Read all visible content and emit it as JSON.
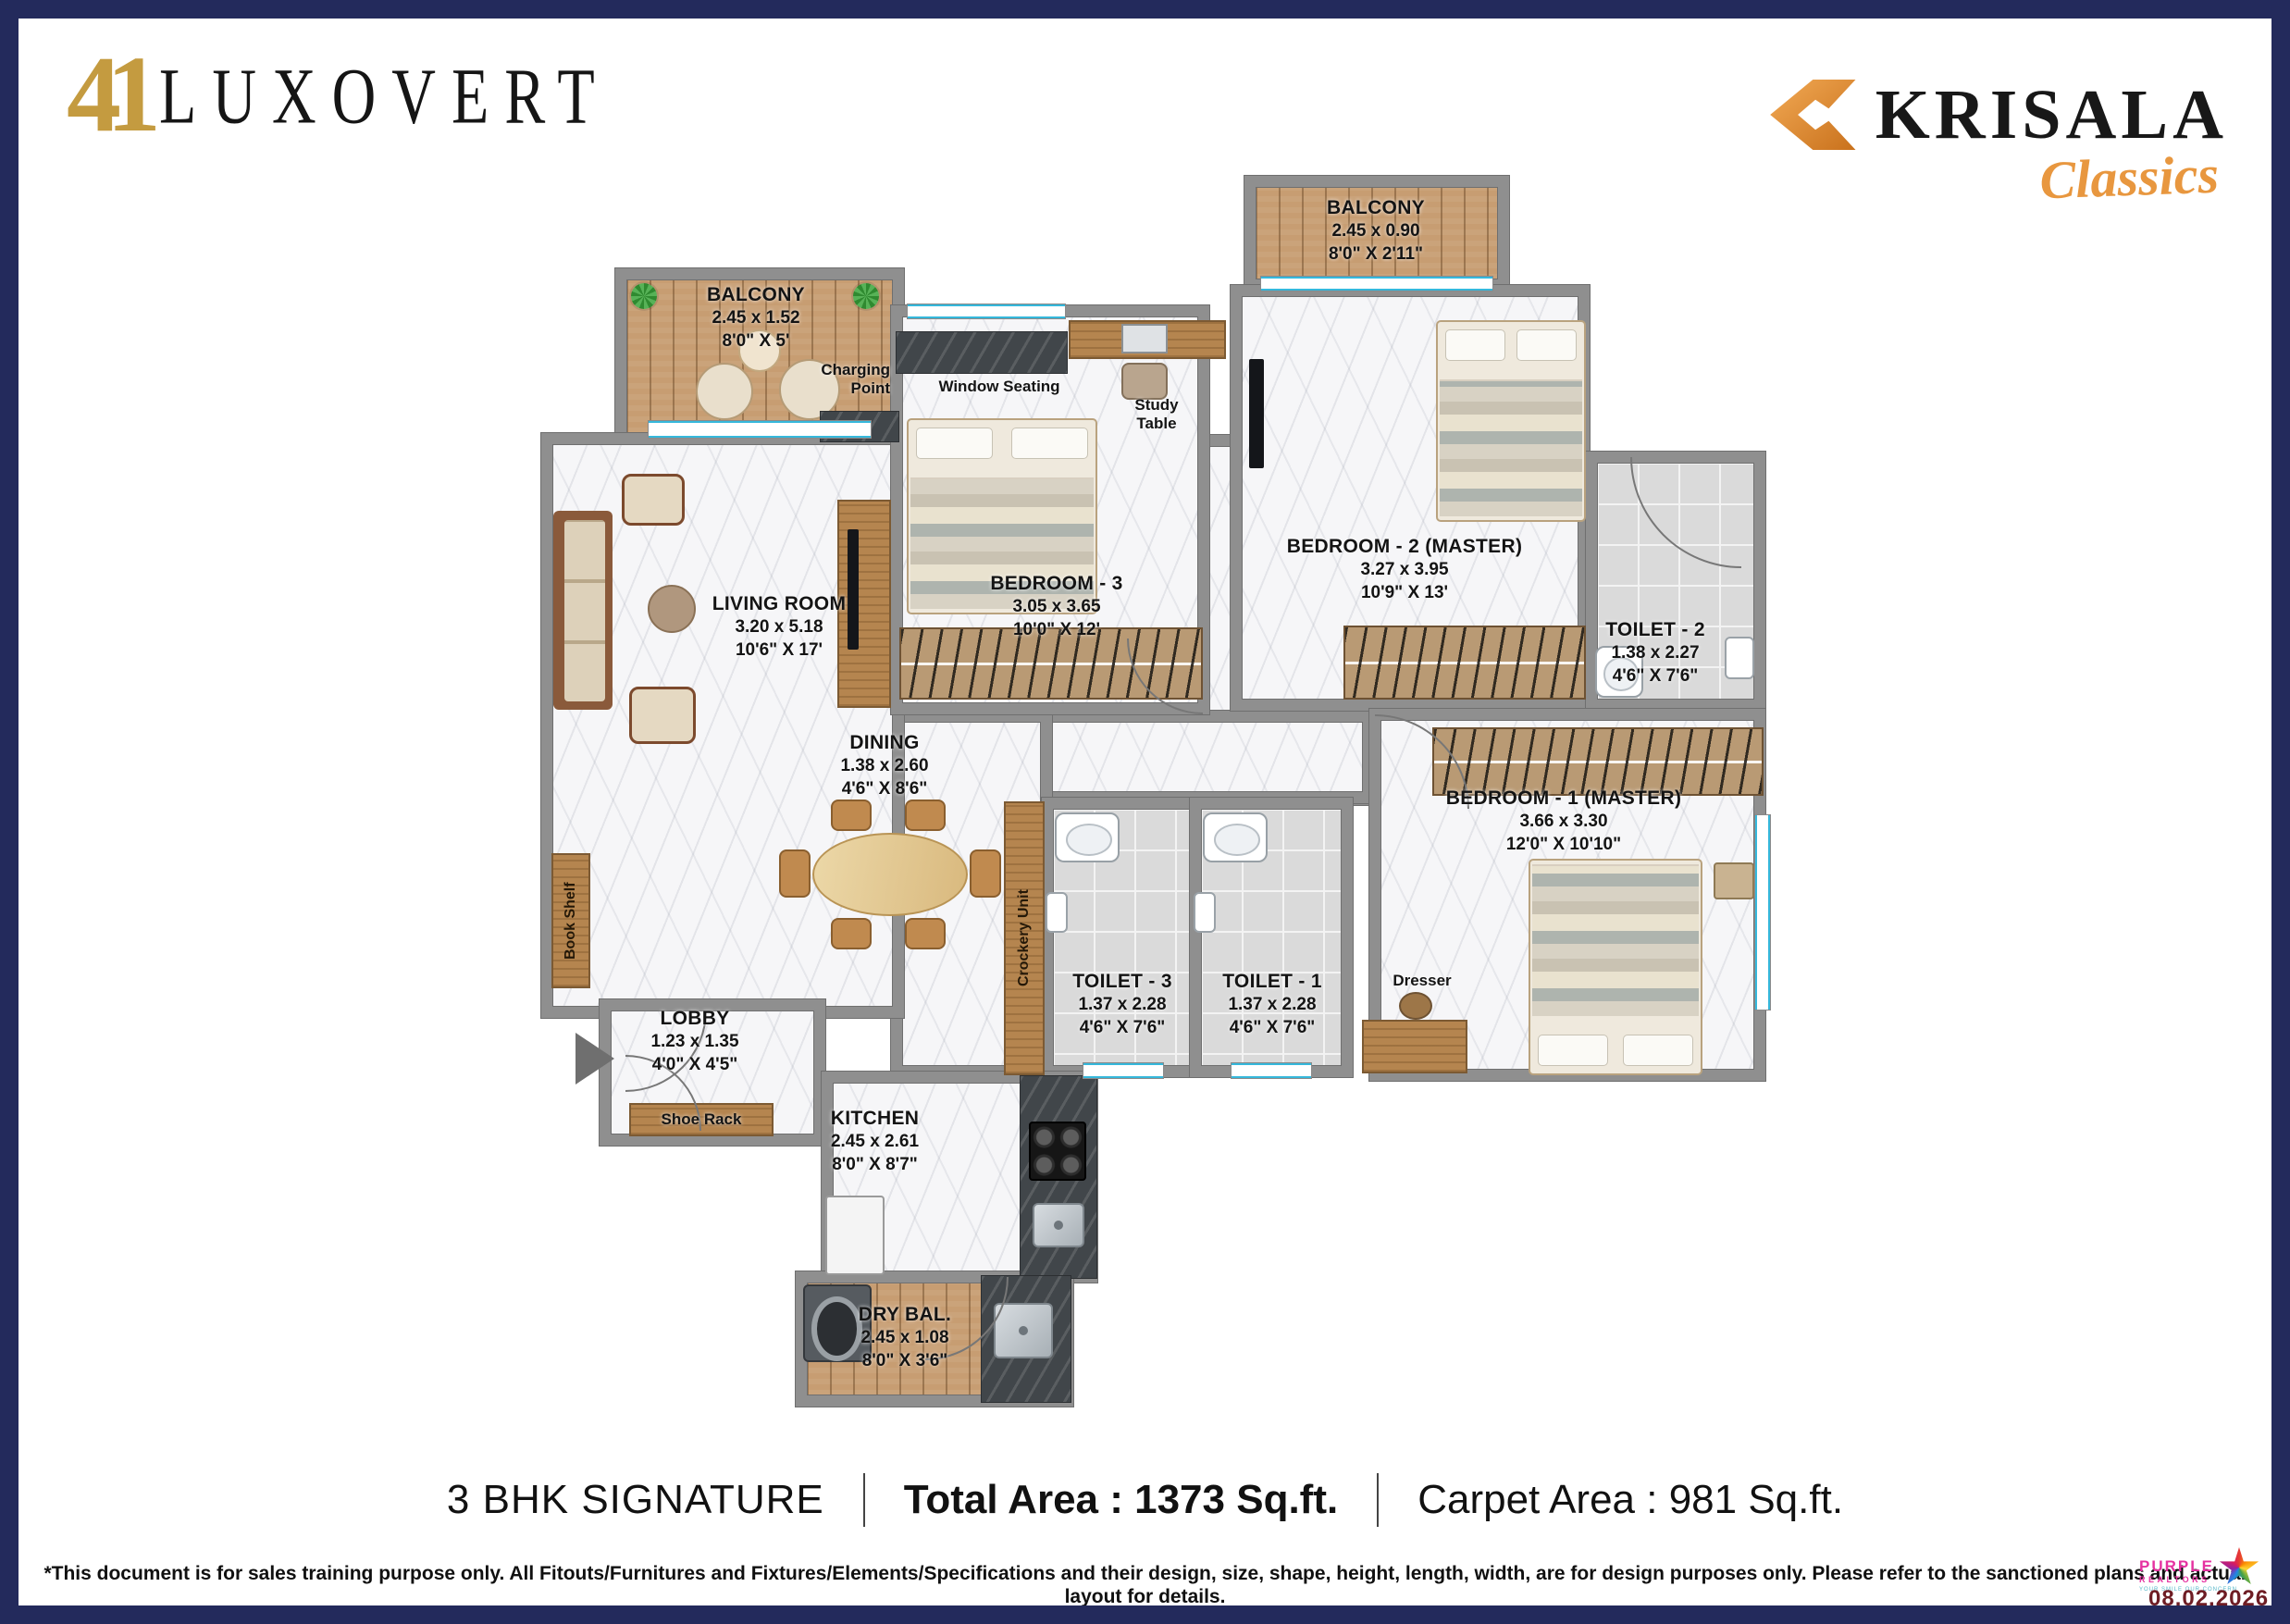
{
  "header": {
    "logo_number": "41",
    "logo_name": "LUXOVERT",
    "brand_name": "KRISALA",
    "brand_sub": "Classics"
  },
  "rooms": {
    "balcony_left": {
      "name": "BALCONY",
      "dim_m": "2.45 x 1.52",
      "dim_ft": "8'0\" X 5'"
    },
    "balcony_top": {
      "name": "BALCONY",
      "dim_m": "2.45 x 0.90",
      "dim_ft": "8'0\" X 2'11\""
    },
    "living": {
      "name": "LIVING ROOM",
      "dim_m": "3.20 x 5.18",
      "dim_ft": "10'6\" X 17'"
    },
    "dining": {
      "name": "DINING",
      "dim_m": "1.38 x 2.60",
      "dim_ft": "4'6\" X 8'6\""
    },
    "bedroom3": {
      "name": "BEDROOM - 3",
      "dim_m": "3.05 x 3.65",
      "dim_ft": "10'0\" X 12'"
    },
    "bedroom2": {
      "name": "BEDROOM - 2 (MASTER)",
      "dim_m": "3.27 x 3.95",
      "dim_ft": "10'9\" X 13'"
    },
    "bedroom1": {
      "name": "BEDROOM - 1 (MASTER)",
      "dim_m": "3.66 x 3.30",
      "dim_ft": "12'0\" X 10'10\""
    },
    "toilet2": {
      "name": "TOILET - 2",
      "dim_m": "1.38 x 2.27",
      "dim_ft": "4'6\" X 7'6\""
    },
    "toilet3": {
      "name": "TOILET - 3",
      "dim_m": "1.37 x 2.28",
      "dim_ft": "4'6\" X 7'6\""
    },
    "toilet1": {
      "name": "TOILET - 1",
      "dim_m": "1.37 x 2.28",
      "dim_ft": "4'6\" X 7'6\""
    },
    "lobby": {
      "name": "LOBBY",
      "dim_m": "1.23 x 1.35",
      "dim_ft": "4'0\" X 4'5\""
    },
    "kitchen": {
      "name": "KITCHEN",
      "dim_m": "2.45 x 2.61",
      "dim_ft": "8'0\" X 8'7\""
    },
    "dry_balcony": {
      "name": "DRY BAL.",
      "dim_m": "2.45 x 1.08",
      "dim_ft": "8'0\" X 3'6\""
    }
  },
  "annotations": {
    "charging_point": "Charging Point",
    "window_seating": "Window Seating",
    "study_table": "Study Table",
    "crockery_unit": "Crockery Unit",
    "book_shelf": "Book Shelf",
    "shoe_rack": "Shoe Rack",
    "dresser": "Dresser"
  },
  "footer": {
    "plan_type": "3 BHK SIGNATURE",
    "total_area": "Total Area : 1373 Sq.ft.",
    "carpet_area": "Carpet Area : 981 Sq.ft.",
    "disclaimer": "*This document is for sales training purpose only. All Fitouts/Furnitures and Fixtures/Elements/Specifications and their design, size, shape, height, length, width, are for design purposes only. Please refer to the sanctioned plans and actual layout for details."
  },
  "watermark": {
    "line1": "PURPLE",
    "line2": "REALTORS",
    "tagline": "YOUR SMILE OUR CONCERN",
    "date": "08.02.2026"
  },
  "colors": {
    "border_navy": "#232a5c",
    "logo_gold": "#c49b40",
    "brand_orange": "#e8973f",
    "wall_gray": "#8f8f8f",
    "window_cyan": "#35b8dc",
    "realtor_magenta": "#e531a0",
    "date_red": "#6e1d24"
  }
}
